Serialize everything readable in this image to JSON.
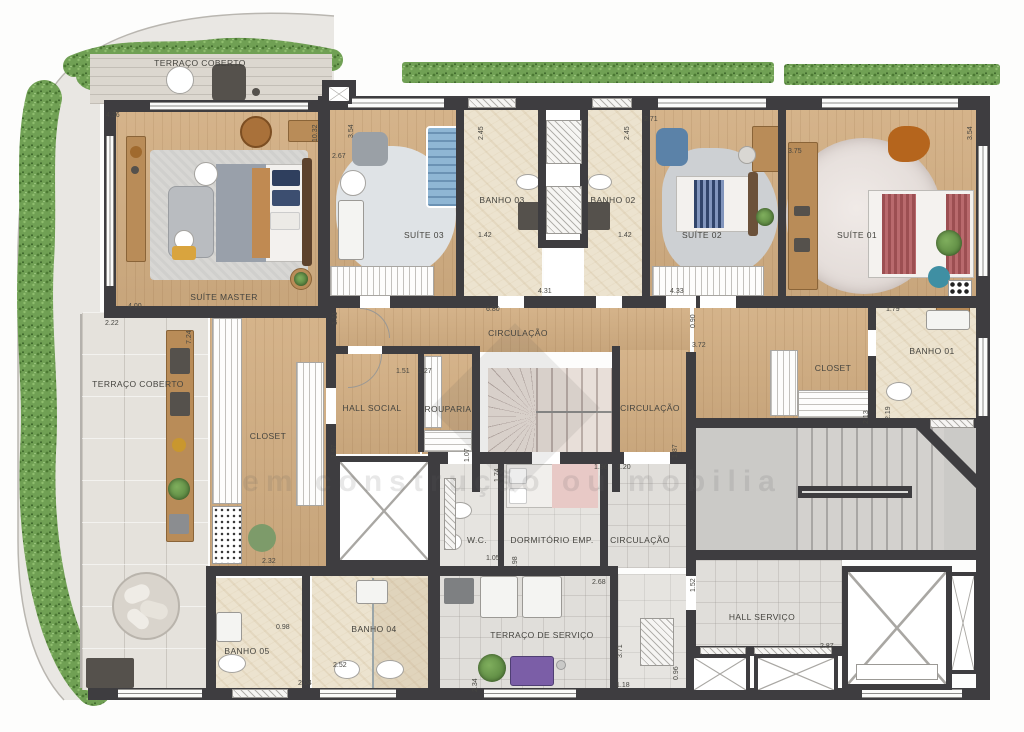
{
  "labels": {
    "terraco_top": "TERRAÇO COBERTO",
    "suite_master": "SUÍTE MASTER",
    "suite_03": "SUÍTE 03",
    "banho_03": "BANHO 03",
    "banho_02": "BANHO 02",
    "suite_02": "SUÍTE 02",
    "suite_01": "SUÍTE 01",
    "circulacao_1": "CIRCULAÇÃO",
    "terraco_left": "TERRAÇO COBERTO",
    "hall_social": "HALL SOCIAL",
    "rouparia": "ROUPARIA",
    "circulacao_2": "CIRCULAÇÃO",
    "closet_master": "CLOSET",
    "closet_01": "CLOSET",
    "banho_01": "BANHO 01",
    "wc": "W.C.",
    "dormitorio": "DORMITÓRIO EMP.",
    "circulacao_3": "CIRCULAÇÃO",
    "banho_05": "BANHO 05",
    "banho_04": "BANHO 04",
    "terraco_servico": "TERRAÇO DE SERVIÇO",
    "hall_servico": "HALL SERVIÇO"
  },
  "dims": [
    "4.36",
    "10.32",
    "3.54",
    "2.67",
    "2.45",
    "2.45",
    "2.71",
    "3.75",
    "3.54",
    "1.42",
    "1.42",
    "6.80",
    "4.31",
    "4.33",
    "0.90",
    "4.00",
    "2.22",
    "7.24",
    "1.11",
    "1.51",
    "1.27",
    "1.79",
    "3.72",
    "2.19",
    "2.13",
    "1.97",
    "1.07",
    "1.87",
    "1.96",
    "1.20",
    "1.74",
    "1.05",
    "1.98",
    "2.68",
    "1.52",
    "2.32",
    "0.98",
    "2.04",
    "2.52",
    "2.34",
    "3.71",
    "1.18",
    "0.96",
    "2.87"
  ],
  "watermark": {
    "text": "em construção ou mobilia"
  },
  "colors": {
    "wall": "#3e3d40",
    "wood_floor": "#d2ae82",
    "marble_floor": "#ece3cf",
    "terrace_paver": "#e5e2dc",
    "hedge_green": "#70a054",
    "bed_master_duvet": "#99a0aa",
    "bed_suite01_stripe": "#9c4f52",
    "bed_suite02_stripe": "#31456b"
  }
}
